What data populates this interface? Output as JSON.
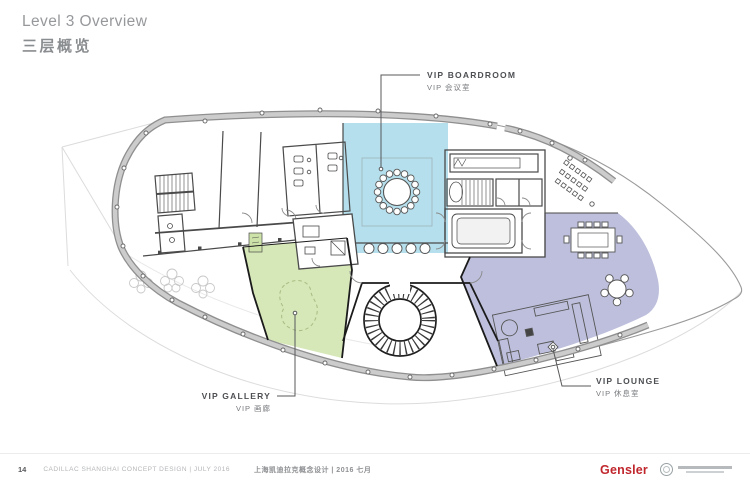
{
  "slide": {
    "title_en": "Level 3 Overview",
    "title_zh": "三层概览"
  },
  "plan": {
    "labels": {
      "boardroom_en": "VIP BOARDROOM",
      "boardroom_zh": "VIP 会议室",
      "gallery_en": "VIP GALLERY",
      "gallery_zh": "VIP 画廊",
      "lounge_en": "VIP LOUNGE",
      "lounge_zh": "VIP 休息室"
    },
    "colors": {
      "boardroom_zone": "#b5dfec",
      "gallery_zone": "#d6e7b8",
      "lounge_zone": "#bdbfdc",
      "facade_band": "#cccccc",
      "facade_edge": "#8f8f8f",
      "wall": "#4a4a4a"
    }
  },
  "footer": {
    "page_number": "14",
    "project_en": "CADILLAC SHANGHAI CONCEPT DESIGN  |  JULY 2016",
    "project_zh": "上海凯迪拉克概念设计 | 2016 七月",
    "brand": "Gensler",
    "brand_color": "#c0272d",
    "partner_logo_icon": "circular-emblem-logo"
  }
}
